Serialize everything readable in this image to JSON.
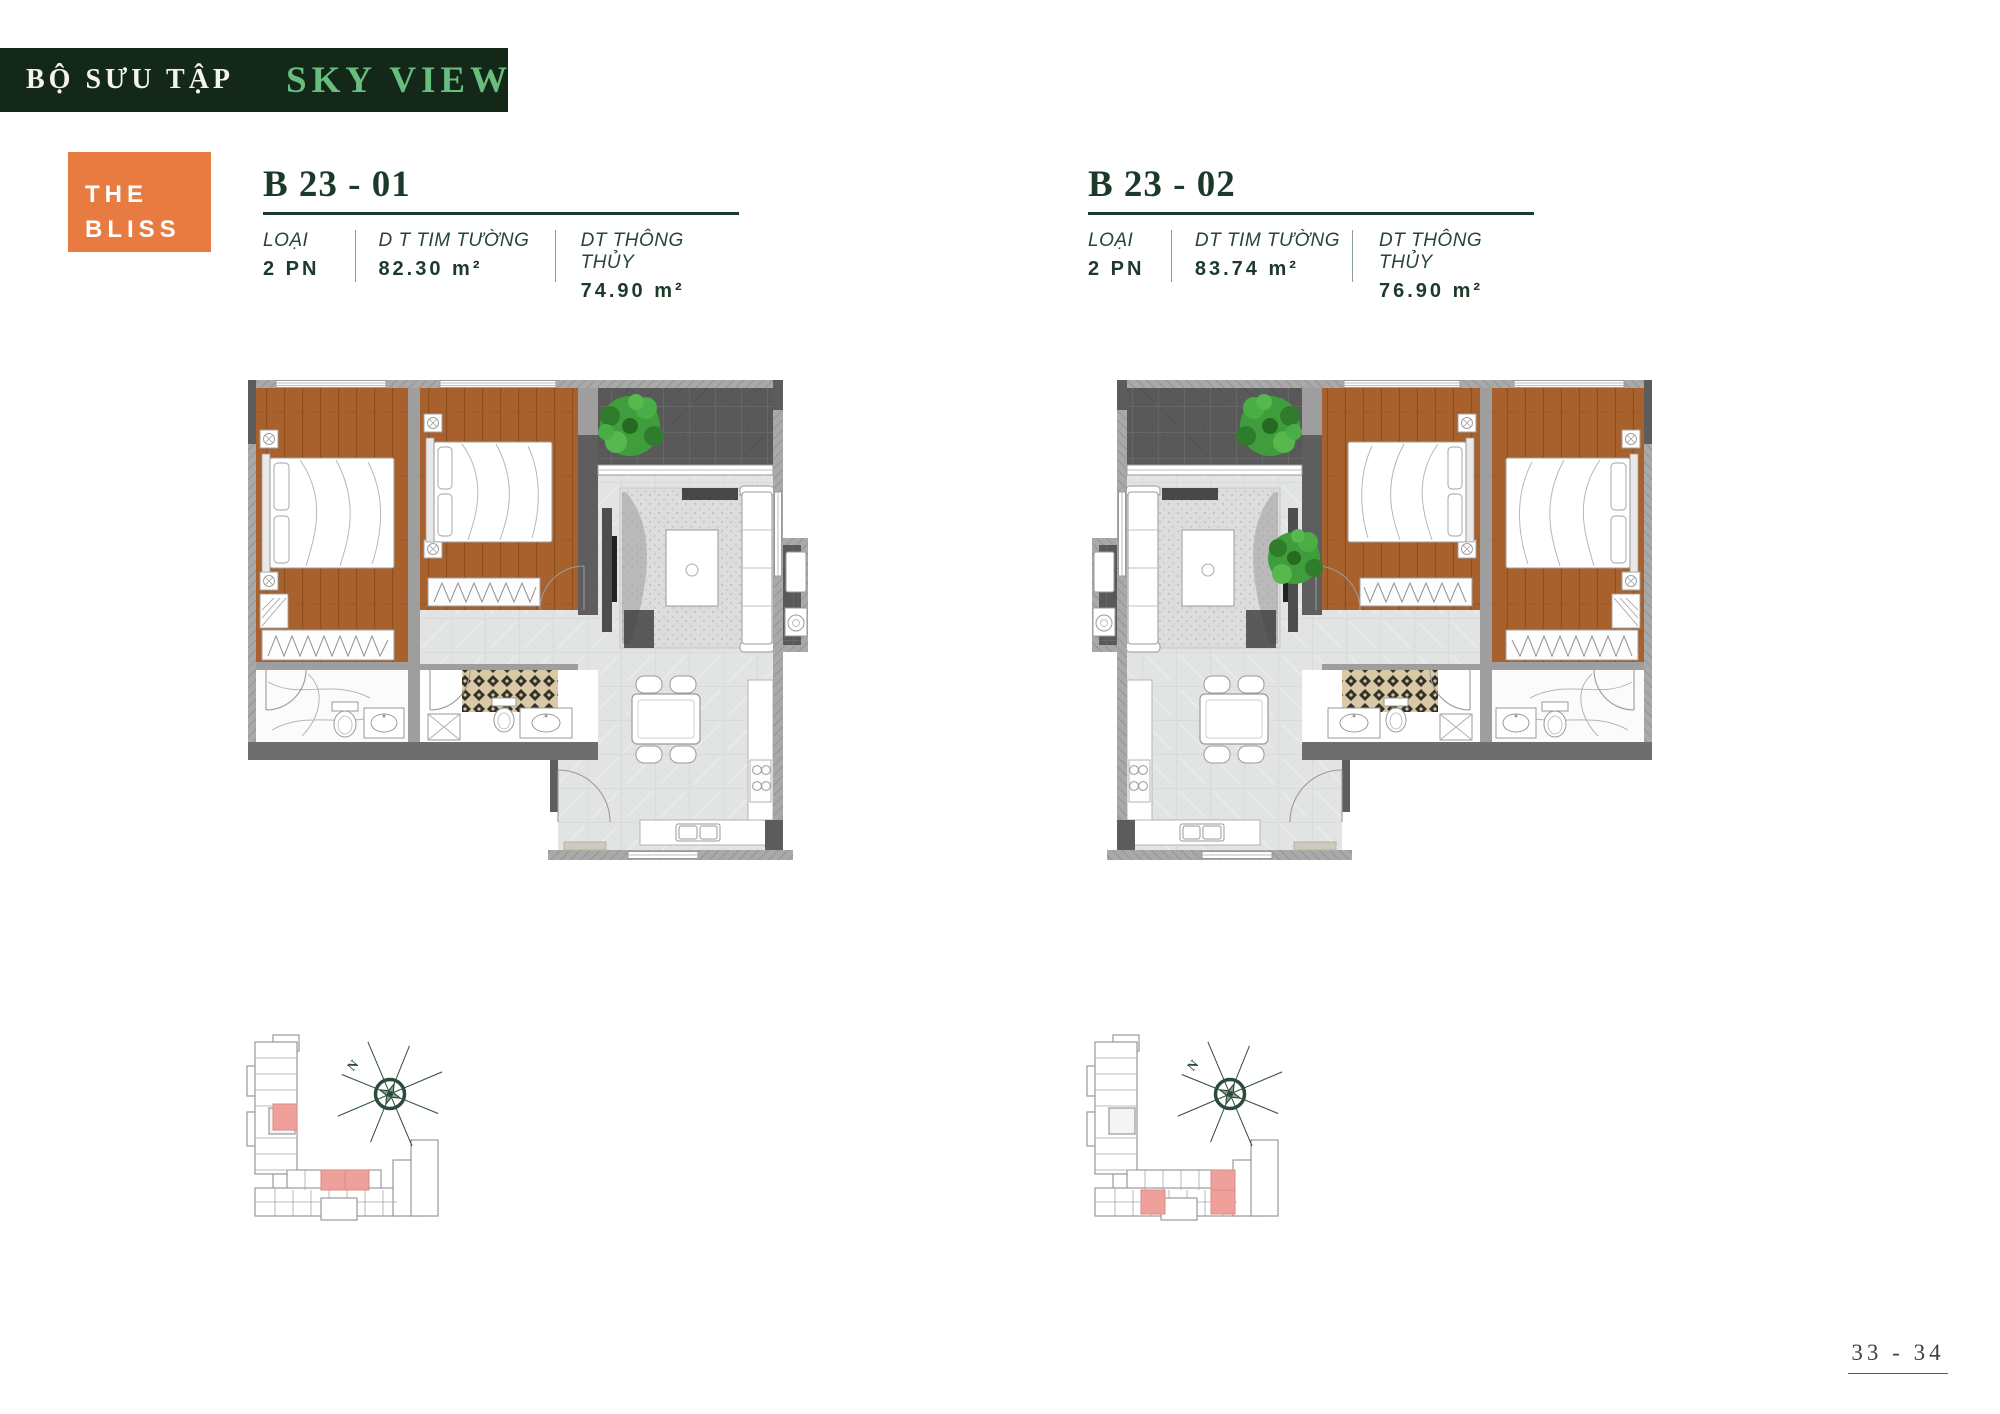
{
  "banner": {
    "collection_label": "BỘ SƯU TẬP",
    "collection_name": "SKY VIEW"
  },
  "logo": {
    "line1": "THE",
    "line2": "BLISS"
  },
  "units": [
    {
      "code": "B 23 - 01",
      "specs": [
        {
          "label": "LOẠI",
          "value": "2 PN"
        },
        {
          "label": "D T TIM TƯỜNG",
          "value": "82.30 m²"
        },
        {
          "label": "DT THÔNG THỦY",
          "value": "74.90 m²"
        }
      ]
    },
    {
      "code": "B 23 - 02",
      "specs": [
        {
          "label": "LOẠI",
          "value": "2 PN"
        },
        {
          "label": "DT TIM TƯỜNG",
          "value": "83.74 m²"
        },
        {
          "label": "DT THÔNG THỦY",
          "value": "76.90 m²"
        }
      ]
    }
  ],
  "site_plan": {
    "north_label": "N"
  },
  "footer": {
    "page_number": "33 - 34"
  },
  "colors": {
    "banner_bg": "#142819",
    "banner_accent": "#68bd7f",
    "logo_bg": "#e87b41",
    "heading_green": "#1c3a2a",
    "wood_floor": "#a8612d",
    "tile_floor": "#e2e4e3",
    "wall_gray": "#a9a9a9",
    "dark_wall": "#5c5c5c",
    "plant_green": "#3f9e3b",
    "unit_highlight_pink": "#f0a09b",
    "compass_green": "#2c4c3b"
  }
}
